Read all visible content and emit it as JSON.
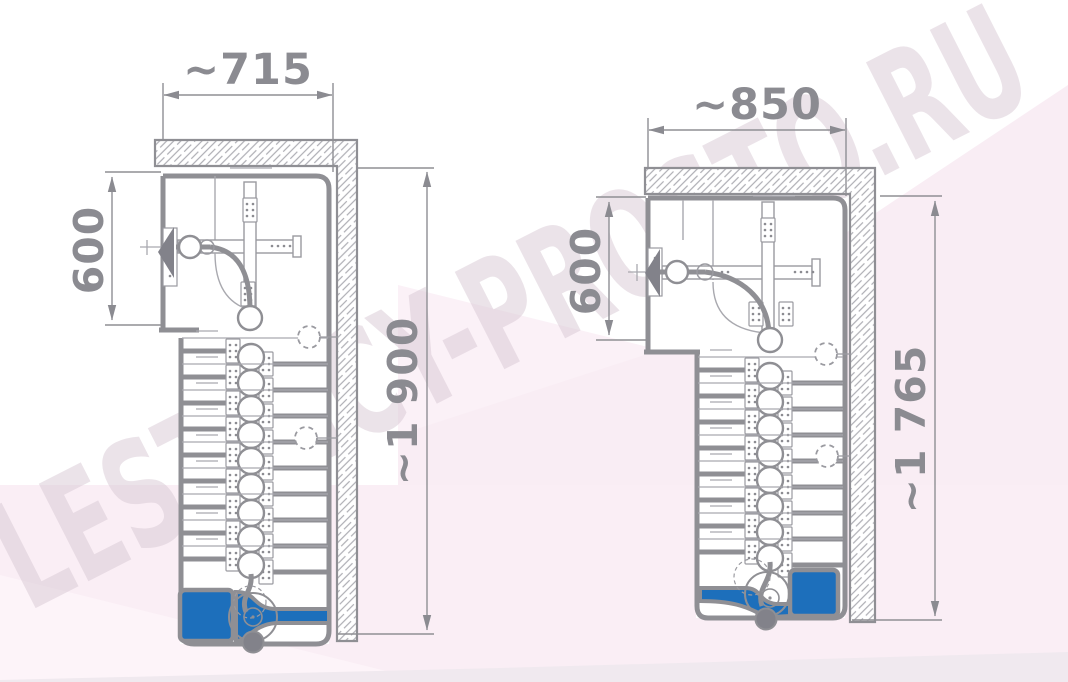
{
  "watermark": {
    "text": "LESTNICY-PROSTO.RU"
  },
  "drawings": [
    {
      "name": "left-stair-plan",
      "width_label": "~715",
      "landing_depth_label": "600",
      "length_label": "~1 900"
    },
    {
      "name": "right-stair-plan",
      "width_label": "~850",
      "landing_depth_label": "600",
      "length_label": "~1 765"
    }
  ],
  "colors": {
    "line": "#8b8b91",
    "thin_line": "#a5a5ab",
    "hatch": "#aeaeb4",
    "accent_blue": "#1d6fbb",
    "background_pink": "#faeef5",
    "watermark": "#d8c9d4"
  }
}
